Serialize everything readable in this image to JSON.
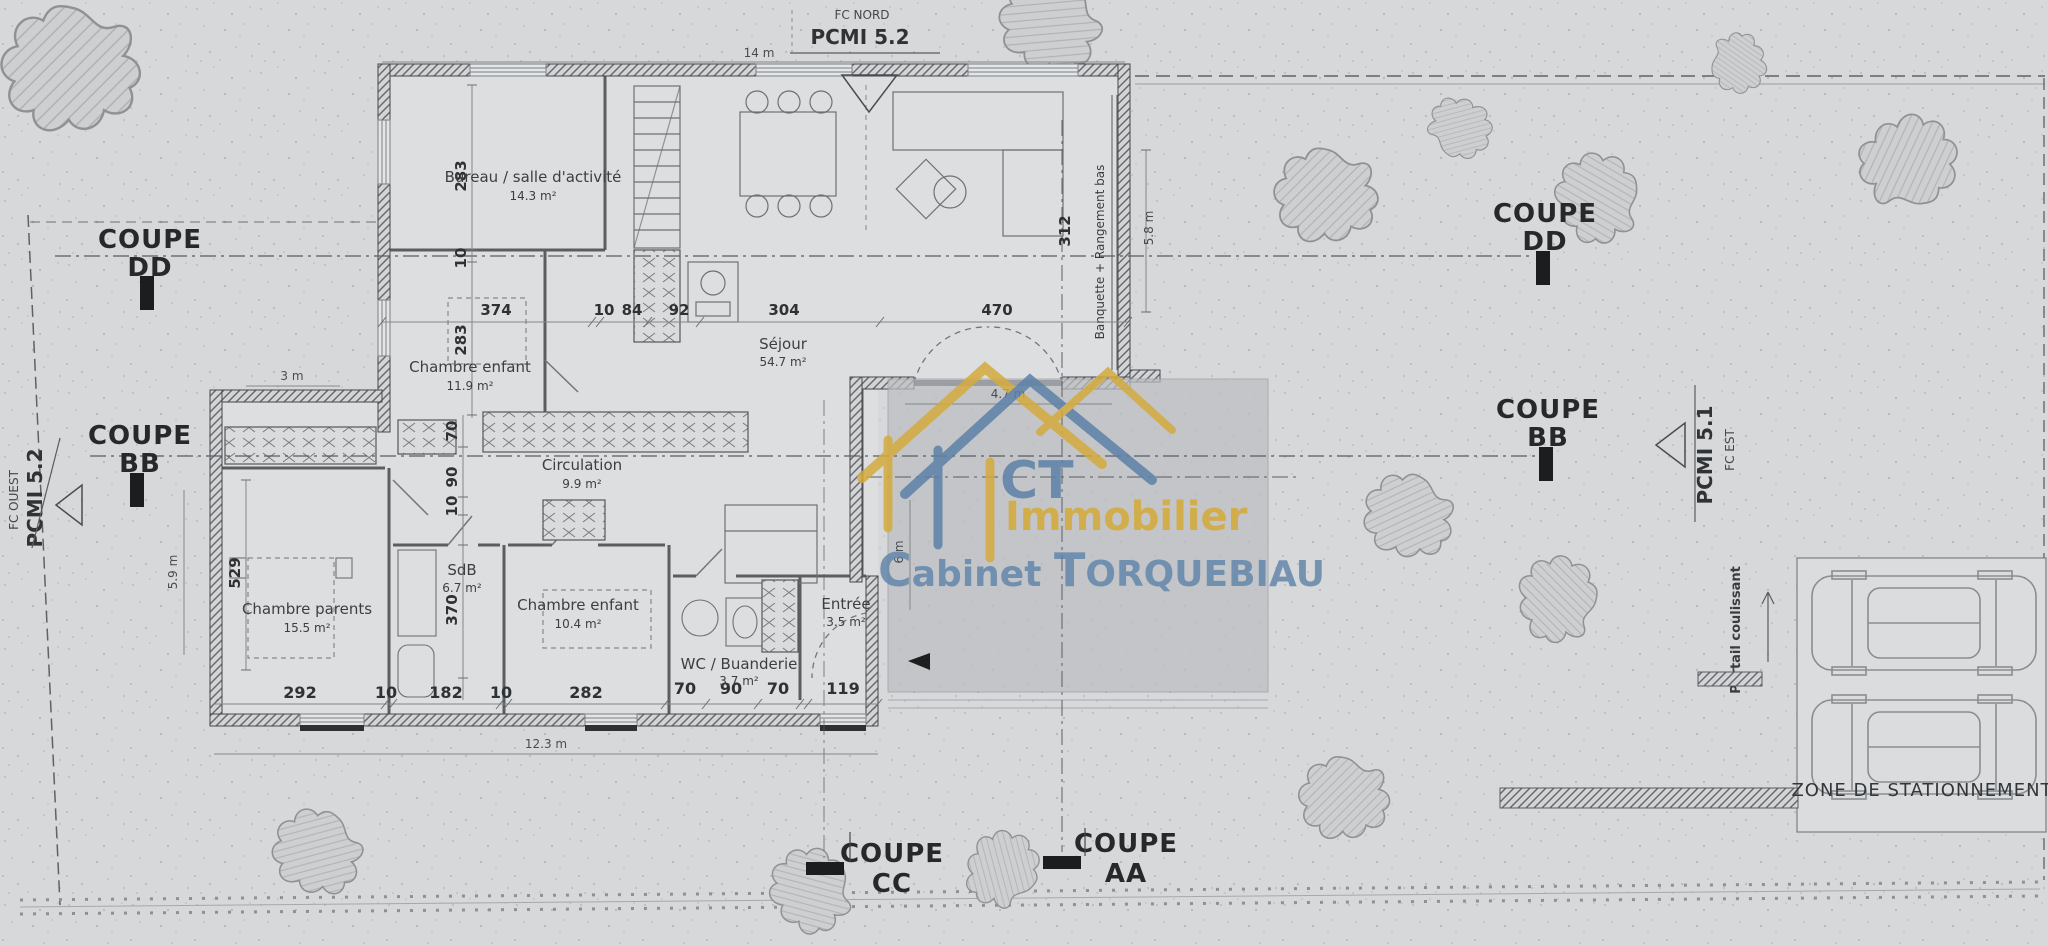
{
  "watermark": {
    "ct": "CT",
    "immobilier": "Immobilier",
    "cab_c": "C",
    "cab_rest": "abinet ",
    "t_c": "T",
    "t_rest": "ORQUEBIAU",
    "blue": "#5d82a8",
    "gold": "#d4ab3e"
  },
  "north": {
    "fc": "FC NORD",
    "pcmi": "PCMI 5.2"
  },
  "west": {
    "fc": "FC OUEST",
    "pcmi": "PCMI 5.2"
  },
  "east": {
    "pcmi": "PCMI 5.1",
    "fc": "FC EST"
  },
  "sections": {
    "coupe": "COUPE",
    "dd": "DD",
    "bb": "BB",
    "cc": "CC",
    "aa": "AA"
  },
  "rooms": [
    {
      "name": "Bureau / salle d'activité",
      "area": "14.3 m²"
    },
    {
      "name": "Chambre enfant",
      "area": "11.9 m²"
    },
    {
      "name": "Séjour",
      "area": "54.7 m²"
    },
    {
      "name": "Circulation",
      "area": "9.9 m²"
    },
    {
      "name": "Chambre parents",
      "area": "15.5 m²"
    },
    {
      "name": "SdB",
      "area": "6.7 m²"
    },
    {
      "name": "Chambre enfant",
      "area": "10.4 m²"
    },
    {
      "name": "WC / Buanderie",
      "area": "3.7 m²"
    },
    {
      "name": "Entrée",
      "area": "3.5 m²"
    }
  ],
  "dims": {
    "top": [
      "374",
      "10",
      "84",
      "92",
      "304",
      "470"
    ],
    "bottom": [
      "292",
      "10",
      "182",
      "10",
      "282",
      "70",
      "90",
      "70",
      "119"
    ],
    "vertical": [
      "283",
      "10",
      "283",
      "70",
      "90",
      "10",
      "529",
      "370",
      "312"
    ],
    "meters": [
      "14 m",
      "3 m",
      "5.9 m",
      "12.3 m",
      "4.7 m",
      "6 m",
      "5.8 m"
    ]
  },
  "annotations": {
    "portail": "Portail coulissant",
    "banquette": "Banquette + Rangement bas",
    "parking": "ZONE DE STATIONNEMENT"
  }
}
